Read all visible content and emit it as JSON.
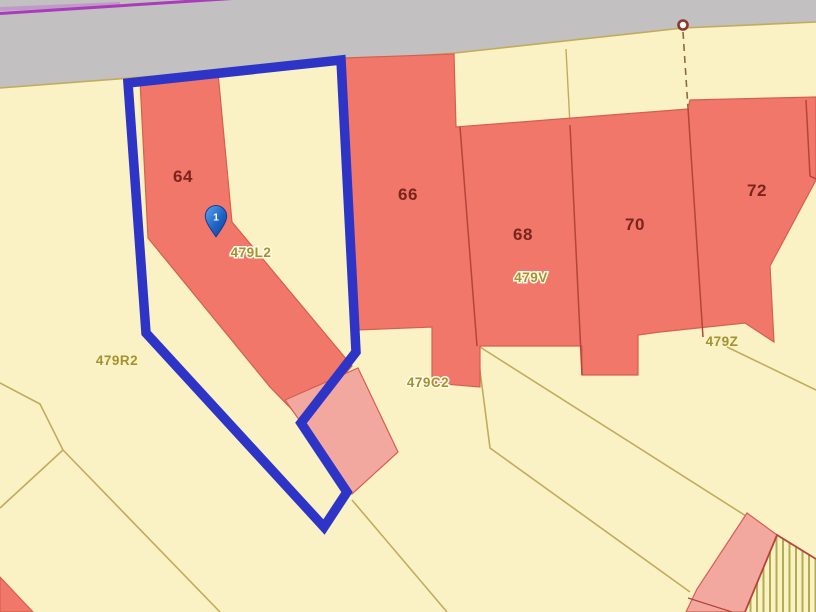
{
  "map": {
    "colors": {
      "road": "#c2c0c1",
      "land": "#faf2c5",
      "building": "#f0776a",
      "building_light": "#f3a89f",
      "building_edge": "#d4604e",
      "building_divider_line": "#b5443a",
      "selection_outline": "#2e35c6",
      "survey_magenta_line": "#a93cba",
      "parcel_boundary_line": "#c3ab5c",
      "dashed_boundary_line": "#8a6d3b",
      "hatch_stripe": "#b2ad4f",
      "marker_pin_blue": "#2a6fd1",
      "vertex_ring": "#8b382c",
      "house_number_text": "#7a241c",
      "parcel_label_text": "#a3922f",
      "label_halo": "#fffbe8"
    },
    "selected_marker": {
      "label": "1"
    },
    "building_labels": [
      {
        "text": "64"
      },
      {
        "text": "66"
      },
      {
        "text": "68"
      },
      {
        "text": "70"
      },
      {
        "text": "72"
      }
    ],
    "parcel_labels": [
      {
        "text": "479L2"
      },
      {
        "text": "479R2"
      },
      {
        "text": "479C2"
      },
      {
        "text": "479V"
      },
      {
        "text": "479Z"
      }
    ]
  }
}
